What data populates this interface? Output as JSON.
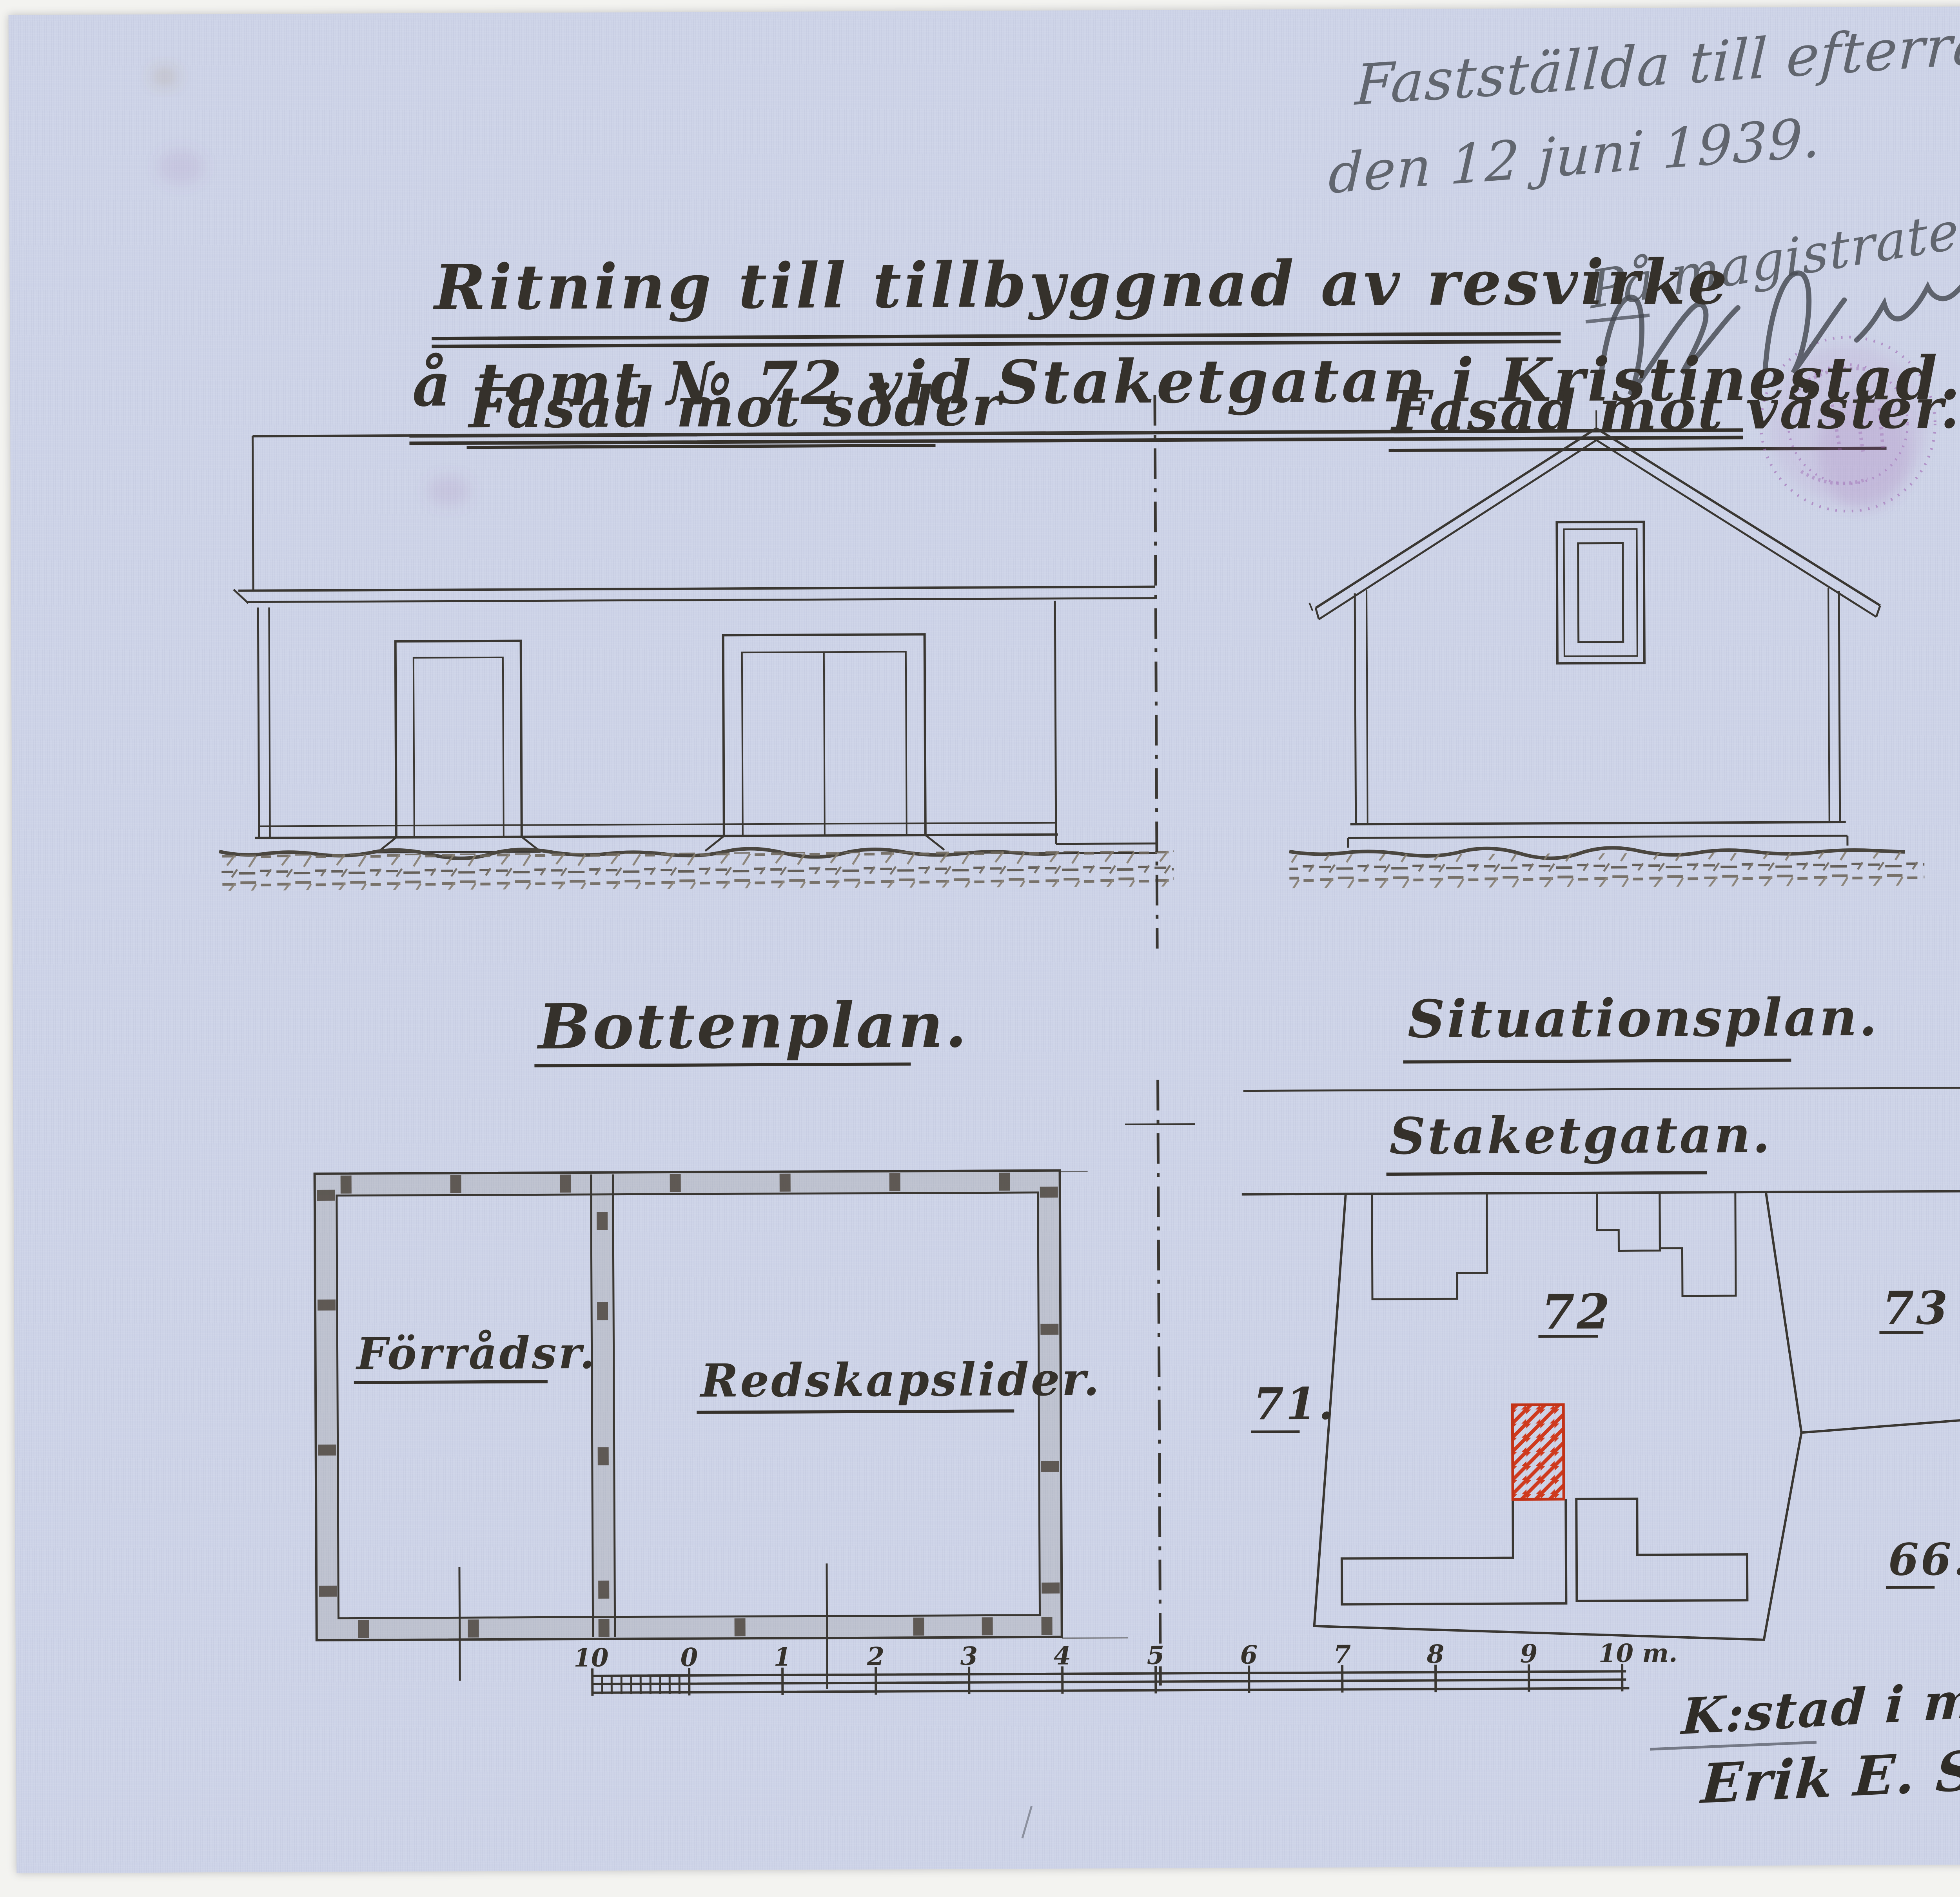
{
  "sheet": {
    "page_number": "27.",
    "approval_note": {
      "line1": "Fastställda till efterrättelse",
      "line2": "den 12 juni 1939.",
      "line3": "På magistratens vägnar."
    },
    "title": {
      "line1": "Ritning till tillbyggnad av resvirke",
      "line2": "å tomt № 72 vid Staketgatan i Kristinestad."
    },
    "signature_block": {
      "place_date": "K:stad i maj 1939.",
      "name": "Erik E. Storthors."
    }
  },
  "elevations": {
    "south": {
      "heading": "Fasad mot söder"
    },
    "west": {
      "heading": "Fasad mot väster."
    }
  },
  "floor_plan": {
    "heading": "Bottenplan.",
    "rooms": [
      {
        "label": "Förrådsr."
      },
      {
        "label": "Redskapslider."
      }
    ]
  },
  "site_plan": {
    "heading": "Situationsplan.",
    "street_label": "Staketgatan.",
    "plots": {
      "main": "72",
      "right": "73",
      "left": "71.",
      "bottom": "66."
    }
  },
  "scale_bar": {
    "tick_labels": [
      "10",
      "0",
      "1",
      "2",
      "3",
      "4",
      "5",
      "6",
      "7",
      "8",
      "9"
    ],
    "end_label": "10 m."
  },
  "colors": {
    "paper": "#ced4e8",
    "ink": "#35312b",
    "addition_red": "#cf3a1e",
    "stamp_purple": "#a06ab5",
    "pencil_gray": "#4a4e55"
  }
}
